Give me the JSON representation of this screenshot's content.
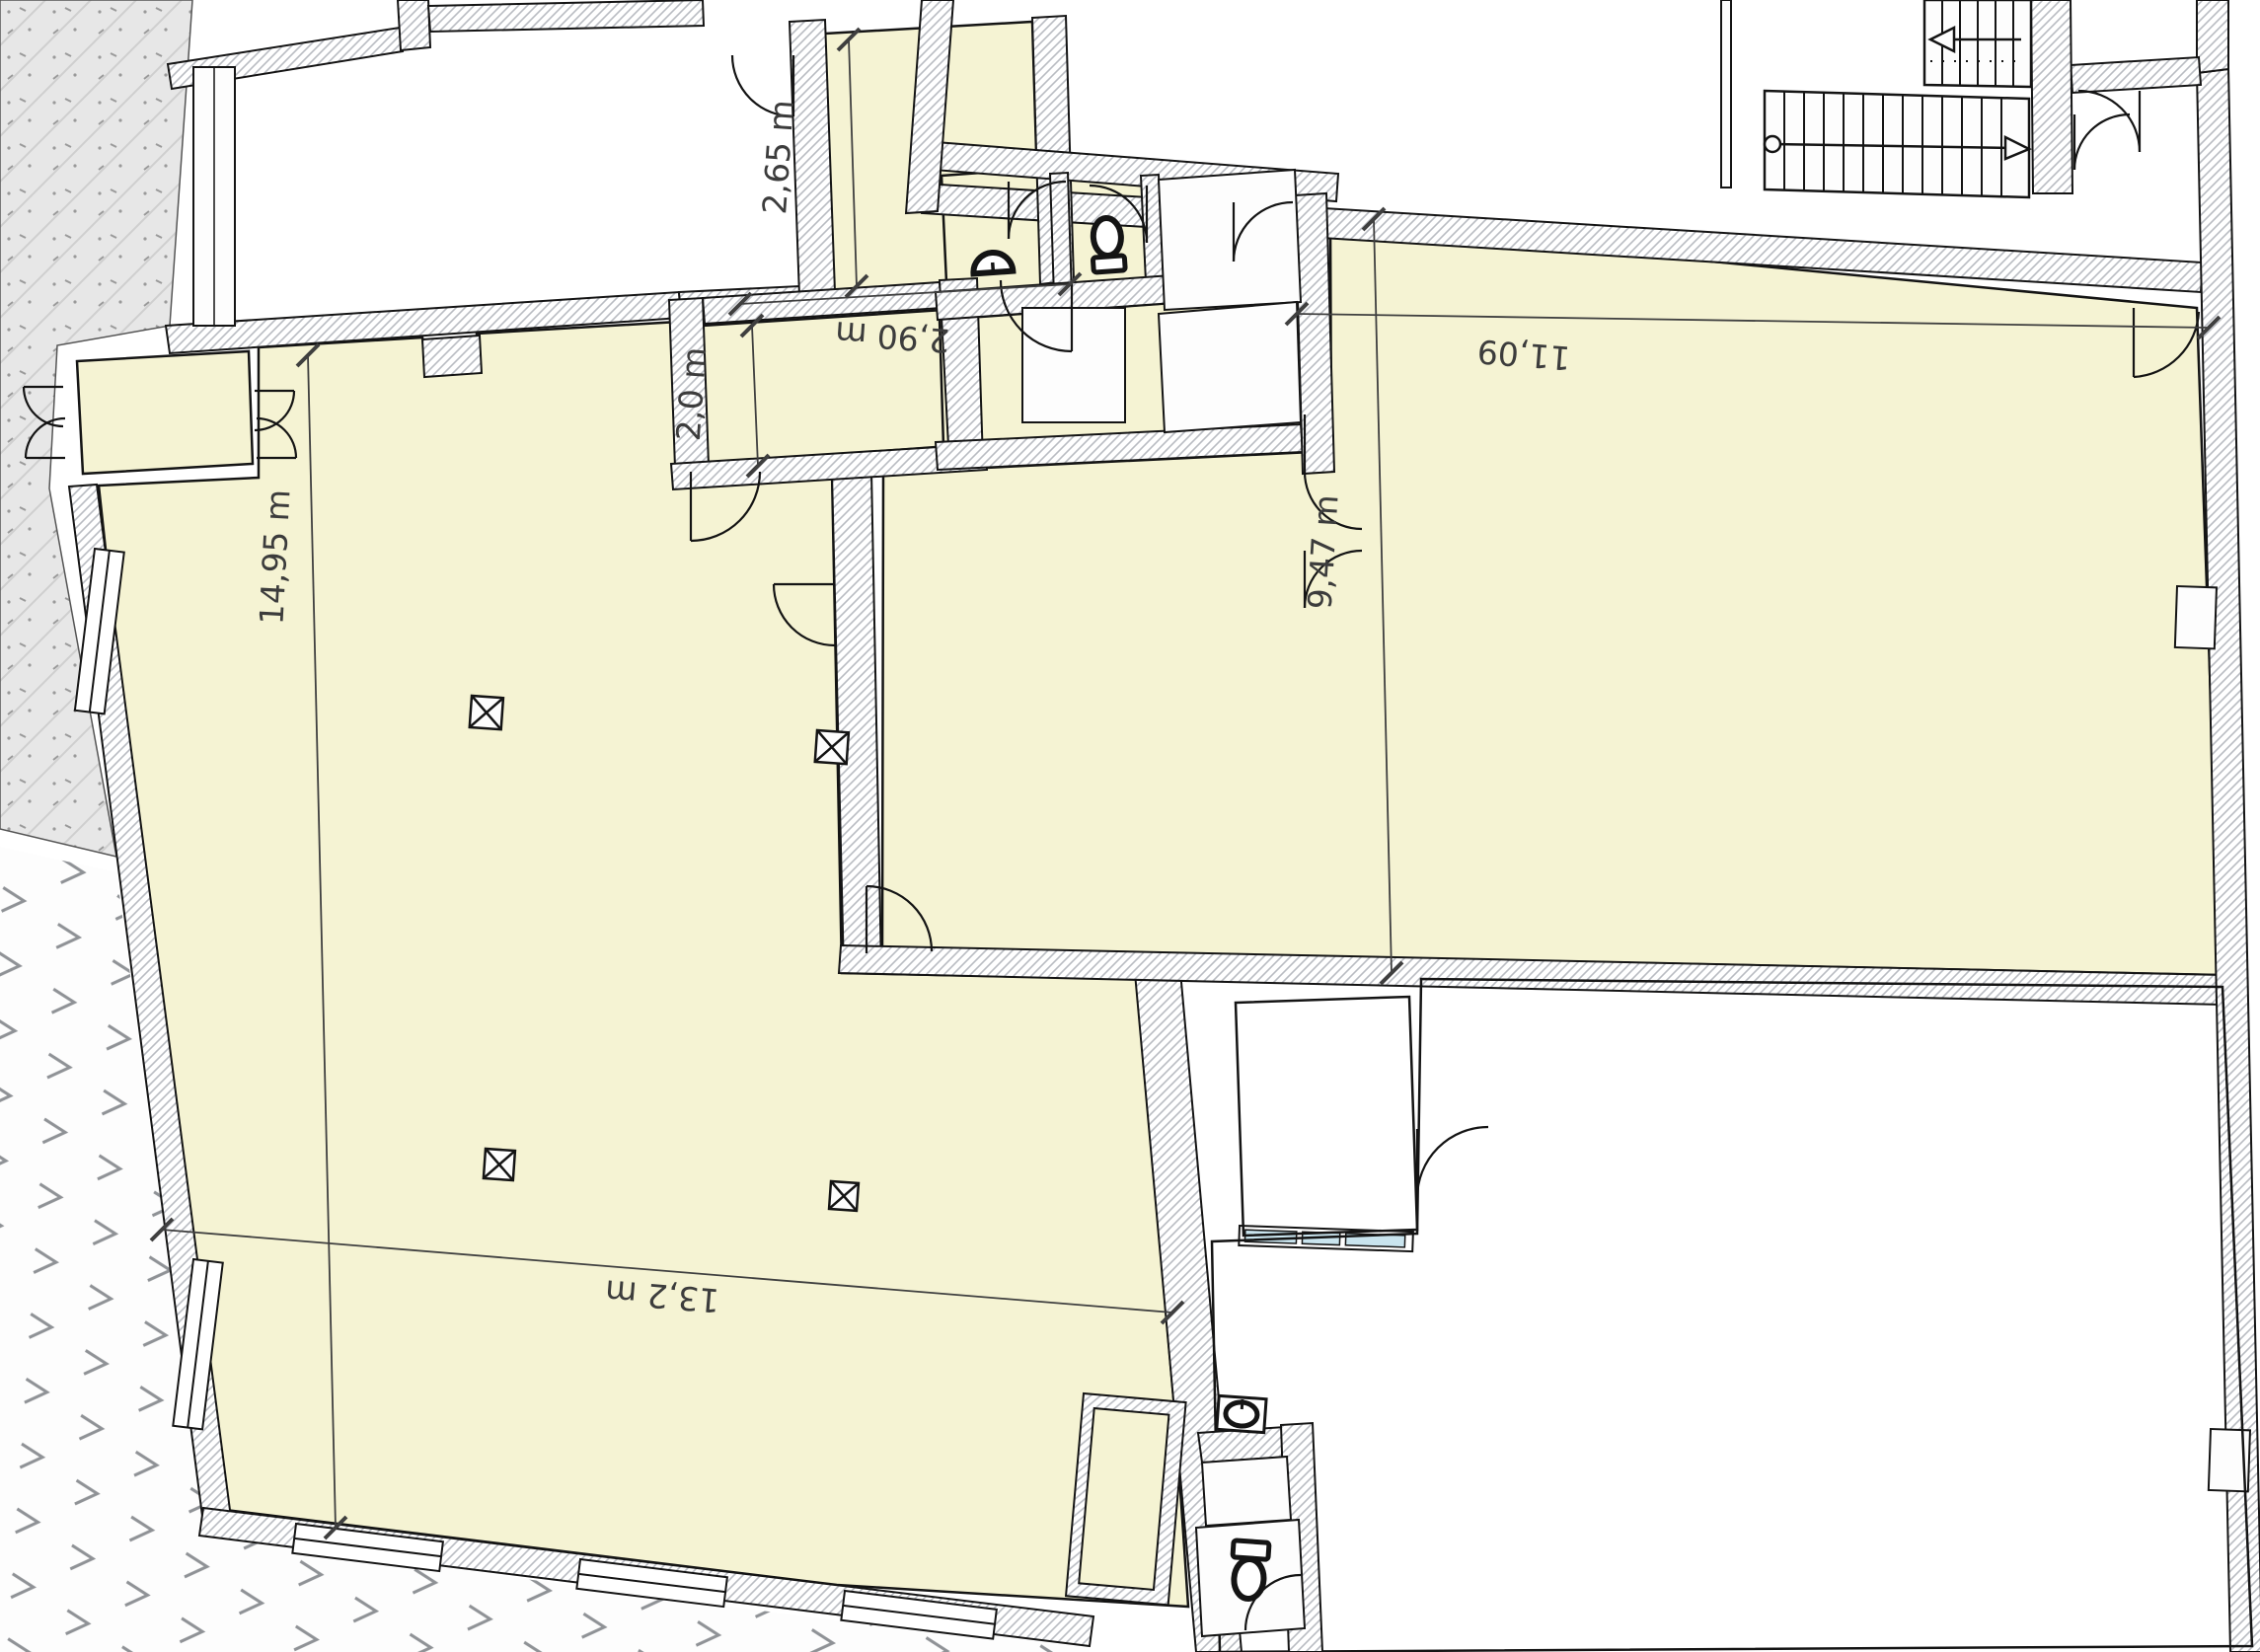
{
  "plan": {
    "type": "architectural floor plan",
    "dimensions": {
      "hall_length": "14,95 m",
      "hall_width": "13,2 m",
      "corridor_height": "2,65 m",
      "corridor_width": "2,90 m",
      "back_room_depth": "2,0 m",
      "right_room_width": "11,09",
      "right_room_height": "9,47 m"
    },
    "colors": {
      "room_fill": "#f5f3d3",
      "wall_hatch": "#c3c6ca",
      "neighbor_fill": "#e6e6e6",
      "glass": "#c9e4ee",
      "line": "#141414",
      "dim_line": "#3f3f3f"
    },
    "fixtures": {
      "toilets": 2,
      "sinks": 2,
      "columns": 4,
      "stair_flights": 2
    }
  }
}
